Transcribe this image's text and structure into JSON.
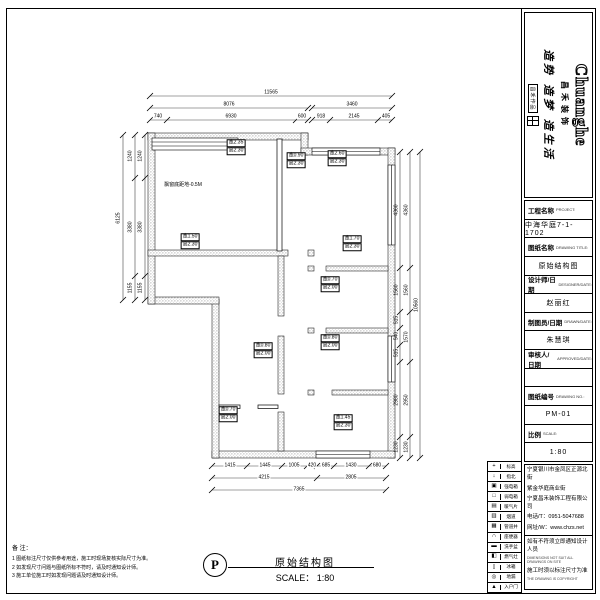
{
  "logo": {
    "brand_en": "Chuanghe",
    "brand_cn": "昌禾装饰",
    "slogan": "造势 造梦 造生活",
    "seal": "昌禾作品"
  },
  "title_block": {
    "rows": [
      {
        "k": "label",
        "cn": "工程名称",
        "en": "PROJECT:"
      },
      {
        "k": "value",
        "t": "中海华庭7-1-1702"
      },
      {
        "k": "label",
        "cn": "图纸名称",
        "en": "DRAWING TITLE:"
      },
      {
        "k": "value",
        "t": "原始结构图"
      },
      {
        "k": "label",
        "cn": "设计师/日期",
        "en": "DESIGNER/DATE:"
      },
      {
        "k": "value",
        "t": "赵丽红"
      },
      {
        "k": "label",
        "cn": "制图员/日期",
        "en": "DRAWN/DATE:"
      },
      {
        "k": "value",
        "t": "朱慧琪"
      },
      {
        "k": "label",
        "cn": "审核人/日期",
        "en": "APPROVED/DATE:"
      },
      {
        "k": "value",
        "t": ""
      },
      {
        "k": "label",
        "cn": "图纸编号",
        "en": "DRAWING NO.:"
      },
      {
        "k": "value",
        "t": "PM-01"
      },
      {
        "k": "label",
        "cn": "比例",
        "en": "SCALE:"
      },
      {
        "k": "value",
        "t": "1:80"
      }
    ]
  },
  "company": {
    "addr1": "宁夏银川市金凤区正源北街",
    "addr2": "紫金华庭商业街",
    "name": "宁夏昌禾装饰工程有限公司",
    "tel": "电话/T：0951-5047688",
    "web": "网址/W：www.chzs.net",
    "warn1": "如有不符须立即通知设计人员",
    "warn1_en": "DIMENSIONS NOT SUIT ALL DRAWINGS ON SITE",
    "warn2": "施工时须以标注尺寸为准",
    "warn2_en": "THE DRAWING IS COPYRIGHT"
  },
  "legend": [
    {
      "icon": "+",
      "label": "标高"
    },
    {
      "icon": "↓",
      "label": "指北"
    },
    {
      "icon": "▣",
      "label": "强电箱"
    },
    {
      "icon": "□",
      "label": "弱电箱"
    },
    {
      "icon": "▤",
      "label": "暖气片"
    },
    {
      "icon": "▥",
      "label": "烟道"
    },
    {
      "icon": "▦",
      "label": "管道井"
    },
    {
      "icon": "∩",
      "label": "座便器"
    },
    {
      "icon": "▬",
      "label": "洗手盆"
    },
    {
      "icon": "◧",
      "label": "燃气灶"
    },
    {
      "icon": "▯",
      "label": "冰箱"
    },
    {
      "icon": "◎",
      "label": "地漏"
    },
    {
      "icon": "▲",
      "label": "入户门"
    }
  ],
  "notes": {
    "title": "备 注：",
    "items": [
      "1 图纸标注尺寸仅供参考用途，施工时现场复核实际尺寸为准。",
      "2 如发现尺寸问题与图纸所标不符时，请及时通知设计师。",
      "3 施工单位施工时如发现问题请及时通知设计师。"
    ]
  },
  "plan_title": {
    "mark": "P",
    "name": "原始结构图",
    "scale": "SCALE： 1:80"
  },
  "plan_texts": [
    {
      "t": "11565",
      "x": 271,
      "y": 93
    },
    {
      "t": "8076",
      "x": 229,
      "y": 105
    },
    {
      "t": "3460",
      "x": 352,
      "y": 105
    },
    {
      "t": "740",
      "x": 158,
      "y": 117
    },
    {
      "t": "6930",
      "x": 231,
      "y": 117
    },
    {
      "t": "600",
      "x": 302,
      "y": 117
    },
    {
      "t": "918",
      "x": 321,
      "y": 117
    },
    {
      "t": "2145",
      "x": 354,
      "y": 117
    },
    {
      "t": "405",
      "x": 386,
      "y": 117
    },
    {
      "t": "6125",
      "x": 119,
      "y": 218,
      "r": -90
    },
    {
      "t": "1240",
      "x": 131,
      "y": 156,
      "r": -90
    },
    {
      "t": "3380",
      "x": 131,
      "y": 227,
      "r": -90
    },
    {
      "t": "1155",
      "x": 131,
      "y": 288,
      "r": -90
    },
    {
      "t": "1240",
      "x": 141,
      "y": 156,
      "r": -90
    },
    {
      "t": "3380",
      "x": 141,
      "y": 227,
      "r": -90
    },
    {
      "t": "1155",
      "x": 141,
      "y": 288,
      "r": -90
    },
    {
      "t": "4360",
      "x": 397,
      "y": 210,
      "r": -90
    },
    {
      "t": "1560",
      "x": 397,
      "y": 290,
      "r": -90
    },
    {
      "t": "515",
      "x": 397,
      "y": 320,
      "r": -90
    },
    {
      "t": "540",
      "x": 397,
      "y": 336,
      "r": -90
    },
    {
      "t": "515",
      "x": 397,
      "y": 353,
      "r": -90
    },
    {
      "t": "2980",
      "x": 397,
      "y": 400,
      "r": -90
    },
    {
      "t": "1230",
      "x": 397,
      "y": 447,
      "r": -90
    },
    {
      "t": "4360",
      "x": 407,
      "y": 210,
      "r": -90
    },
    {
      "t": "1560",
      "x": 407,
      "y": 290,
      "r": -90
    },
    {
      "t": "1570",
      "x": 407,
      "y": 337,
      "r": -90
    },
    {
      "t": "2950",
      "x": 407,
      "y": 400,
      "r": -90
    },
    {
      "t": "1230",
      "x": 407,
      "y": 447,
      "r": -90
    },
    {
      "t": "10560",
      "x": 417,
      "y": 305,
      "r": -90
    },
    {
      "t": "1415",
      "x": 230,
      "y": 466
    },
    {
      "t": "1445",
      "x": 265,
      "y": 466
    },
    {
      "t": "1005",
      "x": 294,
      "y": 466
    },
    {
      "t": "420",
      "x": 312,
      "y": 466
    },
    {
      "t": "685",
      "x": 326,
      "y": 466
    },
    {
      "t": "1430",
      "x": 351,
      "y": 466
    },
    {
      "t": "680",
      "x": 377,
      "y": 466
    },
    {
      "t": "4215",
      "x": 264,
      "y": 478
    },
    {
      "t": "2805",
      "x": 351,
      "y": 478
    },
    {
      "t": "7365",
      "x": 299,
      "y": 490
    }
  ],
  "plan_labels": [
    {
      "x": 236,
      "y": 147,
      "a": "宽2.35",
      "b": "高2.30"
    },
    {
      "x": 296,
      "y": 160,
      "a": "宽0.90",
      "b": "高2.30"
    },
    {
      "x": 183,
      "y": 186,
      "t": "飘窗底距地-0.5M"
    },
    {
      "x": 190,
      "y": 241,
      "a": "宽1.50",
      "b": "高2.30"
    },
    {
      "x": 352,
      "y": 243,
      "a": "宽1.70",
      "b": "高2.30"
    },
    {
      "x": 337,
      "y": 158,
      "a": "宽2.60",
      "b": "高2.30"
    },
    {
      "x": 330,
      "y": 284,
      "a": "宽0.70",
      "b": "高2.00"
    },
    {
      "x": 330,
      "y": 342,
      "a": "宽0.80",
      "b": "高2.00"
    },
    {
      "x": 263,
      "y": 350,
      "a": "宽0.80",
      "b": "高2.00"
    },
    {
      "x": 228,
      "y": 414,
      "a": "宽0.70",
      "b": "高2.00"
    },
    {
      "x": 343,
      "y": 422,
      "a": "宽1.45",
      "b": "高2.30"
    }
  ]
}
